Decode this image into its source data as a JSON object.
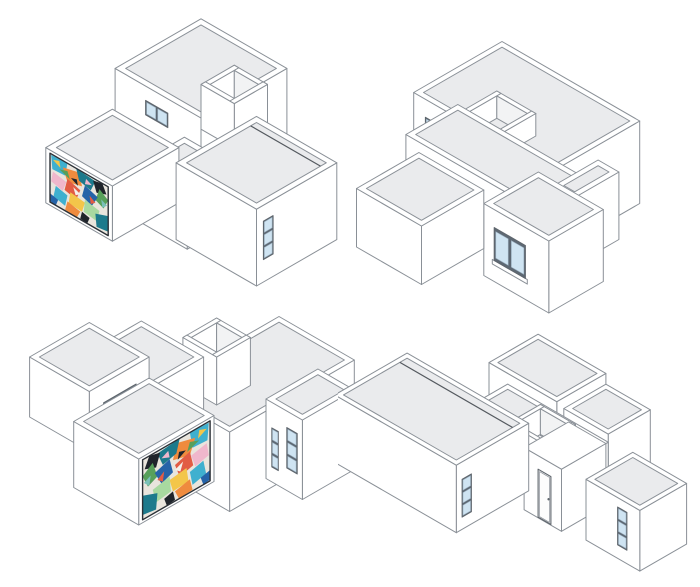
{
  "figure": {
    "title": "axonometric-house-study-four-views",
    "view_count": 4,
    "colors": {
      "background": "#ffffff",
      "wall": "#ffffff",
      "roof": "#eaebed",
      "roof_light": "#f2f3f4",
      "outline": "#8a9097",
      "outline_dark": "#5f666d",
      "glass": "#cfe4f2",
      "window_frame": "#5d6873",
      "seam": "#54595f",
      "door": "#fdfdfd",
      "mural_frame": "#2b3036",
      "mural_base": "#e9e5dd"
    },
    "mural": {
      "palette": [
        "#1d7a8c",
        "#3fb0cf",
        "#2563a8",
        "#ef8b3e",
        "#e25c44",
        "#f3c64a",
        "#57a05a",
        "#a8d9a0",
        "#f0b7cc",
        "#1f242b",
        "#f4f1ea",
        "#7ac0b8"
      ],
      "shapes": [
        [
          1,
          0.02,
          0.98,
          0.3,
          1.0,
          0.26,
          0.72,
          0.04,
          0.7
        ],
        [
          3,
          0.22,
          0.86,
          0.5,
          0.95,
          0.55,
          0.7,
          0.3,
          0.62
        ],
        [
          0,
          0.45,
          1.0,
          0.78,
          0.96,
          0.7,
          0.72,
          0.5,
          0.78
        ],
        [
          9,
          0.74,
          0.95,
          0.9,
          1.0,
          0.97,
          0.82,
          0.8,
          0.74
        ],
        [
          6,
          0.85,
          0.85,
          1.0,
          0.72,
          0.92,
          0.5,
          0.78,
          0.58
        ],
        [
          2,
          0.6,
          0.75,
          0.82,
          0.66,
          0.72,
          0.42,
          0.55,
          0.5
        ],
        [
          4,
          0.3,
          0.68,
          0.52,
          0.6,
          0.45,
          0.36,
          0.25,
          0.42
        ],
        [
          8,
          0.05,
          0.66,
          0.28,
          0.6,
          0.22,
          0.38,
          0.02,
          0.44
        ],
        [
          5,
          0.35,
          0.44,
          0.6,
          0.4,
          0.55,
          0.18,
          0.32,
          0.2
        ],
        [
          7,
          0.6,
          0.46,
          0.85,
          0.4,
          0.8,
          0.16,
          0.58,
          0.2
        ],
        [
          0,
          0.78,
          0.3,
          1.0,
          0.4,
          1.0,
          0.08,
          0.8,
          0.04
        ],
        [
          1,
          0.1,
          0.4,
          0.3,
          0.34,
          0.26,
          0.1,
          0.06,
          0.16
        ],
        [
          3,
          0.3,
          0.22,
          0.52,
          0.16,
          0.46,
          0.0,
          0.26,
          0.02
        ],
        [
          9,
          0.55,
          0.18,
          0.68,
          0.14,
          0.64,
          0.0,
          0.52,
          0.02
        ],
        [
          2,
          0.0,
          0.18,
          0.14,
          0.14,
          0.1,
          0.0,
          0.0,
          0.02
        ],
        [
          4,
          0.68,
          0.6,
          0.78,
          0.52,
          0.7,
          0.44
        ],
        [
          10,
          0.4,
          0.58,
          0.52,
          0.52,
          0.44,
          0.44
        ],
        [
          6,
          0.16,
          0.78,
          0.3,
          0.84,
          0.34,
          0.7
        ],
        [
          8,
          0.62,
          0.9,
          0.72,
          0.84,
          0.6,
          0.78
        ],
        [
          5,
          0.05,
          0.9,
          0.16,
          0.95,
          0.18,
          0.82
        ],
        [
          9,
          0.36,
          0.74,
          0.46,
          0.78,
          0.48,
          0.66
        ],
        [
          11,
          0.88,
          0.66,
          0.98,
          0.6,
          0.9,
          0.5
        ]
      ]
    },
    "views": [
      {
        "name": "axonometric-view-top-left",
        "left": 40,
        "top": 2,
        "width": 320,
        "height": 300,
        "k": 16,
        "ox": 222,
        "oy": 76,
        "boxes": [
          {
            "n": "back-block",
            "b": [
              -1.6,
              4.6,
              2.8,
              9.0,
              0,
              4.3
            ],
            "t": "s",
            "roof": 1,
            "f": [
              {
                "t": "win",
                "face": "y",
                "u": [
                  0.6,
                  2.2
                ],
                "z": [
                  2.5,
                  3.4
                ],
                "panes": 2,
                "dir": "h"
              }
            ]
          },
          {
            "n": "roof-parapet-box",
            "b": [
              1.8,
              4.2,
              3.8,
              6.2,
              0.8,
              3.6
            ],
            "t": "o"
          },
          {
            "n": "wing-connector",
            "b": [
              4.2,
              8.0,
              9.8,
              13.4,
              0,
              3.3
            ],
            "t": "s",
            "roof": 1
          },
          {
            "n": "mural-wing",
            "b": [
              0.0,
              4.8,
              10.8,
              15.6,
              0,
              3.45
            ],
            "t": "s",
            "roof": 1,
            "f": [
              {
                "t": "mural",
                "face": "y",
                "u": [
                  0.3,
                  4.5
                ],
                "z": [
                  0.2,
                  3.25
                ]
              }
            ]
          },
          {
            "n": "main-block",
            "b": [
              7.0,
              12.8,
              7.4,
              13.2,
              0,
              4.8
            ],
            "t": "s",
            "roof": 1,
            "seam": 8.2,
            "f": [
              {
                "t": "win",
                "face": "x",
                "u": [
                  12.0,
                  12.7
                ],
                "z": [
                  1.4,
                  3.8
                ],
                "panes": 3,
                "dir": "v"
              }
            ]
          }
        ]
      },
      {
        "name": "axonometric-view-top-right",
        "left": 352,
        "top": 36,
        "width": 340,
        "height": 285,
        "k": 15,
        "ox": 150,
        "oy": 88,
        "boxes": [
          {
            "n": "main-block",
            "b": [
              0,
              10.6,
              0,
              6.8,
              0,
              5.5
            ],
            "t": "s",
            "roof": 1,
            "f": [
              {
                "t": "win",
                "face": "y",
                "u": [
                  0.9,
                  1.7
                ],
                "z": [
                  1.5,
                  4.3
                ],
                "panes": 3,
                "dir": "v"
              },
              {
                "t": "win",
                "face": "y",
                "u": [
                  3.1,
                  3.9
                ],
                "z": [
                  2.4,
                  3.2
                ],
                "panes": 1,
                "dir": "h"
              }
            ]
          },
          {
            "n": "roof-parapet-box",
            "b": [
              3.8,
              6.8,
              4.2,
              7.0,
              4.7,
              6.2
            ],
            "t": "o"
          },
          {
            "n": "mid-wing",
            "b": [
              1.6,
              12.6,
              5.0,
              9.0,
              0,
              4.6
            ],
            "t": "s",
            "roof": 1
          },
          {
            "n": "side-connector",
            "b": [
              10.6,
              12.2,
              3.2,
              6.6,
              0,
              4.5
            ],
            "t": "s",
            "roof": 1
          },
          {
            "n": "window-block",
            "b": [
              9.4,
              14.4,
              6.6,
              10.8,
              0,
              4.8
            ],
            "t": "s",
            "roof": 1,
            "f": [
              {
                "t": "win",
                "face": "y",
                "u": [
                  10.2,
                  12.6
                ],
                "z": [
                  1.4,
                  3.6
                ],
                "panes": 2,
                "dir": "h",
                "sill": 1
              }
            ]
          },
          {
            "n": "front-low-block",
            "b": [
              2.6,
              7.6,
              9.0,
              13.8,
              0,
              3.9
            ],
            "t": "s",
            "roof": 1
          }
        ]
      },
      {
        "name": "axonometric-view-bottom-left",
        "left": 28,
        "top": 306,
        "width": 330,
        "height": 272,
        "k": 15,
        "ox": 225,
        "oy": 75,
        "boxes": [
          {
            "n": "main-block",
            "b": [
              2.0,
              7.8,
              0,
              9.6,
              0,
              5.3
            ],
            "t": "s",
            "roof": 1
          },
          {
            "n": "roof-parapet-box",
            "b": [
              -1.0,
              1.6,
              1.8,
              4.4,
              1.4,
              4.6
            ],
            "t": "o"
          },
          {
            "n": "wing-connector",
            "b": [
              -4.4,
              0.4,
              4.2,
              8.6,
              0,
              3.9
            ],
            "t": "s",
            "roof": 1
          },
          {
            "n": "low-block",
            "b": [
              -6.2,
              -1.6,
              6.4,
              11.0,
              0,
              4.0
            ],
            "t": "s",
            "roof": 1,
            "f": [
              {
                "t": "win",
                "face": "x",
                "u": [
                  7.4,
                  9.9
                ],
                "z": [
                  1.8,
                  2.7
                ],
                "panes": 3,
                "dir": "h"
              }
            ]
          },
          {
            "n": "mural-wing",
            "b": [
              0.2,
              5.2,
              8.2,
              14.0,
              0,
              4.4
            ],
            "t": "s",
            "roof": 1,
            "f": [
              {
                "t": "mural",
                "face": "x",
                "u": [
                  8.5,
                  13.7
                ],
                "z": [
                  0.2,
                  4.2
                ]
              }
            ]
          },
          {
            "n": "entry-bay",
            "b": [
              7.0,
              9.8,
              2.0,
              6.0,
              0,
              5.3
            ],
            "t": "s",
            "roof": 1,
            "f": [
              {
                "t": "win",
                "face": "y",
                "u": [
                  7.45,
                  7.95
                ],
                "z": [
                  1.0,
                  3.6
                ],
                "panes": 3,
                "dir": "v"
              },
              {
                "t": "win",
                "face": "y",
                "u": [
                  8.6,
                  9.4
                ],
                "z": [
                  1.5,
                  4.2
                ],
                "panes": 3,
                "dir": "v"
              }
            ]
          }
        ]
      },
      {
        "name": "axonometric-view-bottom-right",
        "left": 338,
        "top": 330,
        "width": 362,
        "height": 255,
        "k": 13.5,
        "ox": 158,
        "oy": 96,
        "boxes": [
          {
            "n": "back-block",
            "b": [
              0.6,
              6.4,
              -3.0,
              1.2,
              0,
              5.6
            ],
            "t": "s",
            "roof": 1,
            "f": [
              {
                "t": "win",
                "face": "y",
                "u": [
                  1.6,
                  2.3
                ],
                "z": [
                  3.1,
                  3.8
                ],
                "panes": 1,
                "dir": "h"
              }
            ]
          },
          {
            "n": "back-block-b",
            "b": [
              6.4,
              10.2,
              -3.0,
              0.6,
              0,
              4.8
            ],
            "t": "s",
            "roof": 1
          },
          {
            "n": "roof-strip",
            "b": [
              1.6,
              10.2,
              0.6,
              3.0,
              0,
              4.2
            ],
            "t": "s",
            "roof": 1
          },
          {
            "n": "roof-parapet-box",
            "b": [
              6.0,
              9.0,
              2.2,
              5.0,
              2.2,
              5.7
            ],
            "t": "o"
          },
          {
            "n": "entry-recess",
            "b": [
              7.4,
              10.6,
              1.2,
              5.0,
              0,
              4.6
            ],
            "t": "s",
            "f": [
              {
                "t": "door",
                "face": "y",
                "u": [
                  8.6,
                  9.7
                ],
                "z": [
                  0.05,
                  3.6
                ]
              }
            ]
          },
          {
            "n": "main-block",
            "b": [
              -4.2,
              6.2,
              3.4,
              9.6,
              0,
              5.0
            ],
            "t": "s",
            "roof": 1,
            "seam": 4.4,
            "f": [
              {
                "t": "win",
                "face": "x",
                "u": [
                  8.3,
                  9.1
                ],
                "z": [
                  0.9,
                  3.7
                ],
                "panes": 3,
                "dir": "v"
              }
            ]
          },
          {
            "n": "right-block",
            "b": [
              12.3,
              16.9,
              0.6,
              4.6,
              0,
              4.5
            ],
            "t": "s",
            "roof": 1,
            "f": [
              {
                "t": "win",
                "face": "y",
                "u": [
                  15.0,
                  15.8
                ],
                "z": [
                  1.0,
                  3.8
                ],
                "panes": 3,
                "dir": "v"
              }
            ]
          }
        ]
      }
    ]
  }
}
